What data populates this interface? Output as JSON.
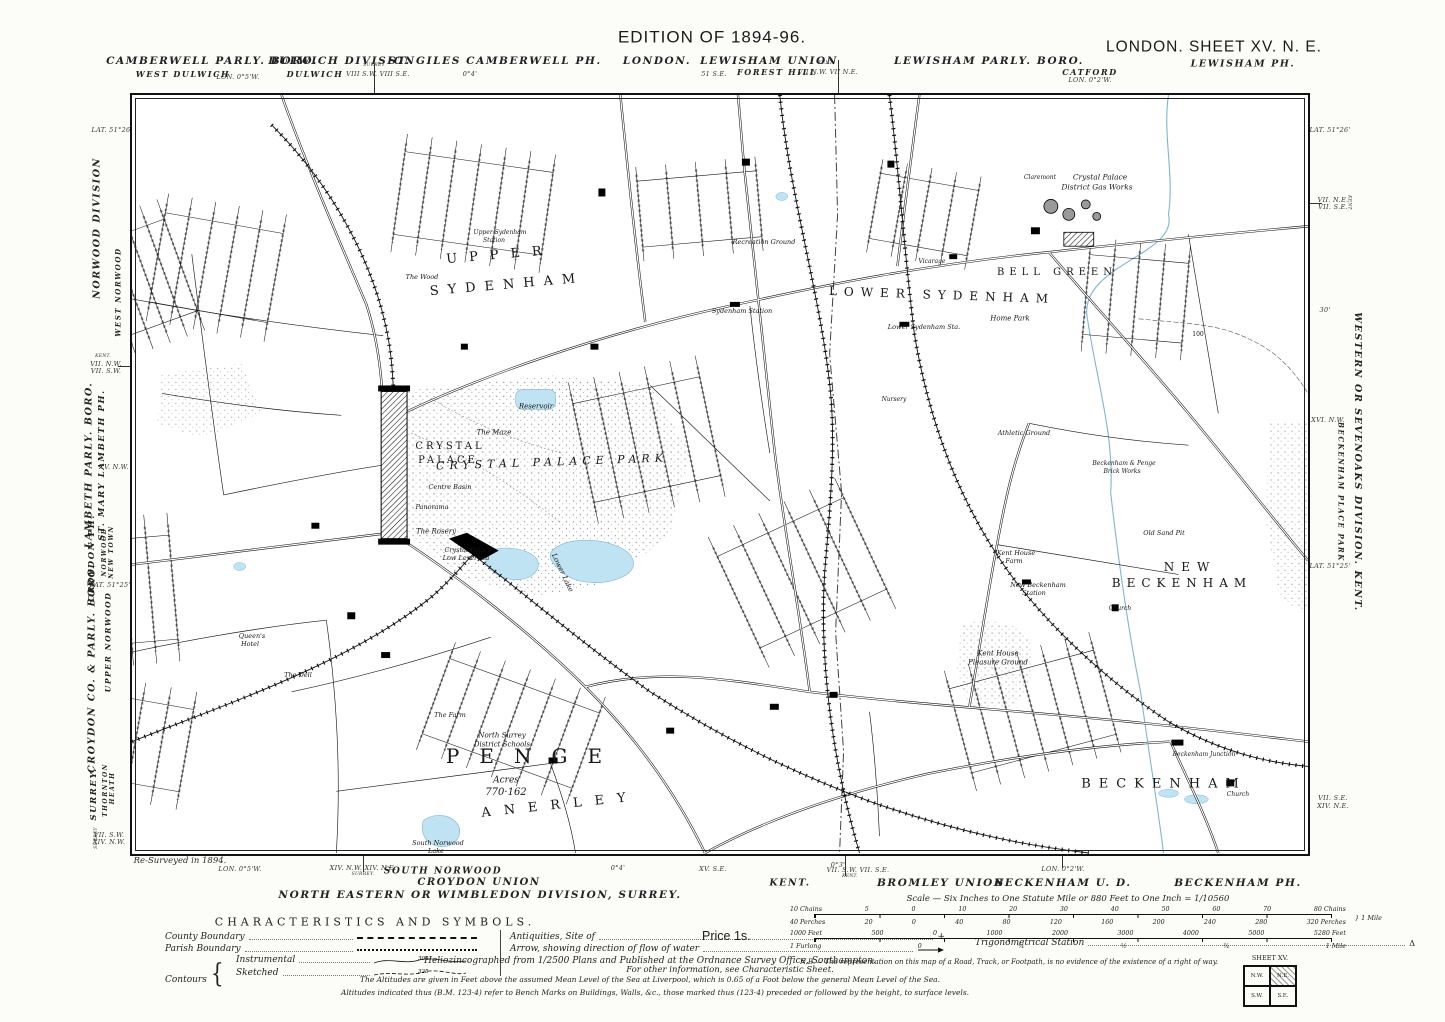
{
  "title": "Ordnance Survey six-inch map, London Sheet XV N.E., Edition of 1894-96",
  "margins": {
    "labels": [
      {
        "t": "EDITION OF 1894-96.",
        "x": 712,
        "y": 37,
        "s": 17,
        "c": "h1"
      },
      {
        "t": "LONDON.  SHEET  XV.  N. E.",
        "x": 1214,
        "y": 47,
        "s": 15.5,
        "c": "h1"
      },
      {
        "t": "LEWISHAM PH.",
        "x": 1243,
        "y": 64,
        "s": 9.5,
        "c": "sbi"
      },
      {
        "t": "CAMBERWELL PARLY. BORO.",
        "x": 212,
        "y": 61,
        "s": 10.5,
        "c": "sbi"
      },
      {
        "t": "WEST DULWICH",
        "x": 183,
        "y": 74,
        "s": 8,
        "c": "sbi"
      },
      {
        "t": "LON. 0°5'W.",
        "x": 238,
        "y": 77,
        "c": "ty"
      },
      {
        "t": "DULWICH DIVISION",
        "x": 342,
        "y": 61,
        "s": 10.5,
        "c": "sbi"
      },
      {
        "t": "DULWICH",
        "x": 315,
        "y": 74,
        "s": 8,
        "c": "sbi"
      },
      {
        "t": "SURREY",
        "x": 374,
        "y": 66,
        "s": 4.5,
        "c": "ty"
      },
      {
        "t": "VIII S.W.   VIII S.E.",
        "x": 378,
        "y": 74,
        "c": "ty"
      },
      {
        "t": "ST. GILES CAMBERWELL PH.",
        "x": 495,
        "y": 61,
        "s": 10.5,
        "c": "sbi"
      },
      {
        "t": "0°4'",
        "x": 470,
        "y": 74,
        "c": "ty"
      },
      {
        "t": "LONDON.",
        "x": 657,
        "y": 61,
        "s": 10.5,
        "c": "sbi"
      },
      {
        "t": "LEWISHAM UNION",
        "x": 769,
        "y": 61,
        "s": 10.5,
        "c": "sbi"
      },
      {
        "t": "FOREST HILL",
        "x": 777,
        "y": 72,
        "s": 8,
        "c": "sbi"
      },
      {
        "t": "51 S.E.",
        "x": 714,
        "y": 74,
        "c": "ty"
      },
      {
        "t": "KENT.",
        "x": 826,
        "y": 64,
        "s": 4.5,
        "c": "ty"
      },
      {
        "t": "VII N.W.   VII N.E.",
        "x": 828,
        "y": 72,
        "c": "ty"
      },
      {
        "t": "LEWISHAM PARLY. BORO.",
        "x": 989,
        "y": 61,
        "s": 10.5,
        "c": "sbi"
      },
      {
        "t": "CATFORD",
        "x": 1090,
        "y": 72,
        "s": 8,
        "c": "sbi"
      },
      {
        "t": "LON. 0°2'W.",
        "x": 1090,
        "y": 80,
        "c": "ty"
      },
      {
        "t": "LAT. 51°26'",
        "x": 112,
        "y": 130,
        "c": "ty"
      },
      {
        "t": "NORWOOD DIVISION",
        "x": 97,
        "y": 228,
        "s": 9.5,
        "c": "sbi",
        "r": -90
      },
      {
        "t": "KENT.",
        "x": 103,
        "y": 357,
        "s": 4.5,
        "c": "ty"
      },
      {
        "t": "VII. N.W.",
        "x": 106,
        "y": 364,
        "c": "ty"
      },
      {
        "t": "VII. S.W.",
        "x": 106,
        "y": 371,
        "c": "ty"
      },
      {
        "t": "WEST NORWOOD",
        "x": 118,
        "y": 292,
        "s": 7,
        "c": "sbi",
        "r": -90
      },
      {
        "t": "LAMBETH PARLY. BORO.",
        "x": 89,
        "y": 465,
        "s": 9.5,
        "c": "sbi",
        "r": -90
      },
      {
        "t": "ST. MARY LAMBETH PH.",
        "x": 102,
        "y": 465,
        "s": 8.5,
        "c": "sbi",
        "r": -90
      },
      {
        "t": "XV. N.W.",
        "x": 114,
        "y": 467,
        "c": "ty"
      },
      {
        "t": "CROYDON PH.",
        "x": 92,
        "y": 558,
        "s": 8.5,
        "c": "sbi",
        "r": -90
      },
      {
        "t": "NORWOOD",
        "x": 105,
        "y": 552,
        "s": 6,
        "c": "sbi",
        "r": -90
      },
      {
        "t": "NEW TOWN",
        "x": 112,
        "y": 552,
        "s": 6,
        "c": "sbi",
        "r": -90
      },
      {
        "t": "LAT. 51°25'",
        "x": 110,
        "y": 585,
        "c": "ty"
      },
      {
        "t": "CROYDON CO. & PARLY. BORO.",
        "x": 92,
        "y": 668,
        "s": 9.5,
        "c": "sbi",
        "r": -90
      },
      {
        "t": "UPPER NORWOOD",
        "x": 108,
        "y": 642,
        "s": 7.5,
        "c": "sbi",
        "r": -90
      },
      {
        "t": "SURREY.",
        "x": 94,
        "y": 794,
        "s": 8.5,
        "c": "sbi",
        "r": -90
      },
      {
        "t": "THORNTON",
        "x": 106,
        "y": 790,
        "s": 6,
        "c": "sbi",
        "r": -90
      },
      {
        "t": "HEATH",
        "x": 113,
        "y": 788,
        "s": 6,
        "c": "sbi",
        "r": -90
      },
      {
        "t": "SURREY",
        "x": 97,
        "y": 838,
        "s": 4.5,
        "c": "ty",
        "r": -90
      },
      {
        "t": "VII. S.W.",
        "x": 109,
        "y": 835,
        "c": "ty"
      },
      {
        "t": "XIV. N.W.",
        "x": 109,
        "y": 842,
        "c": "ty"
      },
      {
        "t": "LAT. 51°26'",
        "x": 1330,
        "y": 130,
        "c": "ty"
      },
      {
        "t": "VII. N.E.",
        "x": 1333,
        "y": 200,
        "c": "ty"
      },
      {
        "t": "VII. S.E.",
        "x": 1333,
        "y": 207,
        "c": "ty"
      },
      {
        "t": "KENT.",
        "x": 1348,
        "y": 203,
        "s": 4.5,
        "c": "ty",
        "r": 90
      },
      {
        "t": "30'",
        "x": 1325,
        "y": 310,
        "c": "ty"
      },
      {
        "t": "WESTERN OR SEVENOAKS DIVISION.  KENT.",
        "x": 1357,
        "y": 462,
        "s": 9.5,
        "c": "sbi",
        "r": 90
      },
      {
        "t": "XVI. N.W.",
        "x": 1328,
        "y": 420,
        "c": "ty"
      },
      {
        "t": "BECKENHAM PLACE PARK",
        "x": 1341,
        "y": 492,
        "s": 7,
        "c": "sbi",
        "r": 90
      },
      {
        "t": "LAT. 51°25'",
        "x": 1330,
        "y": 566,
        "c": "ty"
      },
      {
        "t": "VII. S.E.",
        "x": 1333,
        "y": 798,
        "c": "ty"
      },
      {
        "t": "XIV. N.E.",
        "x": 1333,
        "y": 806,
        "c": "ty"
      },
      {
        "t": "Re-Surveyed in 1894.",
        "x": 180,
        "y": 861,
        "s": 8.5,
        "c": "scr"
      },
      {
        "t": "LON. 0°5'W.",
        "x": 240,
        "y": 869,
        "c": "ty"
      },
      {
        "t": "XIV. N.W.   XIV. N.E.",
        "x": 363,
        "y": 868,
        "c": "ty"
      },
      {
        "t": "SURREY.",
        "x": 363,
        "y": 875,
        "s": 4.5,
        "c": "ty"
      },
      {
        "t": "SOUTH NORWOOD",
        "x": 443,
        "y": 872,
        "s": 9,
        "c": "sbi"
      },
      {
        "t": "CROYDON UNION",
        "x": 479,
        "y": 883,
        "s": 10,
        "c": "sbi"
      },
      {
        "t": "NORTH EASTERN OR WIMBLEDON DIVISION,  SURREY.",
        "x": 480,
        "y": 895,
        "s": 10.5,
        "c": "sbi"
      },
      {
        "t": "0°4'",
        "x": 618,
        "y": 868,
        "c": "ty"
      },
      {
        "t": "XV. S.E.",
        "x": 713,
        "y": 869,
        "c": "ty"
      },
      {
        "t": "KENT.",
        "x": 790,
        "y": 883,
        "s": 9.5,
        "c": "sbi"
      },
      {
        "t": "0°3'",
        "x": 838,
        "y": 865,
        "c": "ty"
      },
      {
        "t": "VII. S.W.   VII. S.E.",
        "x": 858,
        "y": 870,
        "c": "ty"
      },
      {
        "t": "KENT.",
        "x": 850,
        "y": 877,
        "s": 4.5,
        "c": "ty"
      },
      {
        "t": "BROMLEY UNION",
        "x": 941,
        "y": 883,
        "s": 10.5,
        "c": "sbi"
      },
      {
        "t": "LON. 0°2'W.",
        "x": 1063,
        "y": 869,
        "c": "ty"
      },
      {
        "t": "BECKENHAM U. D.",
        "x": 1063,
        "y": 883,
        "s": 10.5,
        "c": "sbi"
      },
      {
        "t": "BECKENHAM PH.",
        "x": 1238,
        "y": 883,
        "s": 10.5,
        "c": "sbi"
      }
    ]
  },
  "map": {
    "labels": [
      {
        "t": "Upper Sydenham",
        "x": 368,
        "y": 138,
        "s": 6,
        "i": 1
      },
      {
        "t": "Station",
        "x": 362,
        "y": 146,
        "s": 6,
        "i": 1
      },
      {
        "t": "The Wood",
        "x": 290,
        "y": 182,
        "s": 6.5,
        "i": 1
      },
      {
        "t": "UPPER",
        "x": 368,
        "y": 160,
        "s": 13,
        "ls": 12,
        "r": -5
      },
      {
        "t": "SYDENHAM",
        "x": 375,
        "y": 190,
        "s": 13,
        "ls": 9,
        "r": -5
      },
      {
        "t": "LOWER SYDENHAM",
        "x": 810,
        "y": 200,
        "s": 12,
        "ls": 7,
        "r": 2
      },
      {
        "t": "BELL GREEN",
        "x": 925,
        "y": 178,
        "s": 10,
        "ls": 5
      },
      {
        "t": "Sydenham Station",
        "x": 610,
        "y": 216,
        "s": 6.5,
        "i": 1
      },
      {
        "t": "Lower Sydenham Sta.",
        "x": 792,
        "y": 232,
        "s": 6.5,
        "i": 1
      },
      {
        "t": "Recreation Ground",
        "x": 632,
        "y": 147,
        "s": 6.5,
        "i": 1
      },
      {
        "t": "Vicarage",
        "x": 800,
        "y": 167,
        "s": 6,
        "i": 1
      },
      {
        "t": "Home Park",
        "x": 878,
        "y": 224,
        "s": 7,
        "i": 1
      },
      {
        "t": "Nursery",
        "x": 762,
        "y": 305,
        "s": 6,
        "i": 1
      },
      {
        "t": "Claremont",
        "x": 908,
        "y": 83,
        "s": 6,
        "i": 1
      },
      {
        "t": "Crystal Palace",
        "x": 968,
        "y": 82,
        "s": 7.5,
        "i": 1
      },
      {
        "t": "District Gas Works",
        "x": 965,
        "y": 92,
        "s": 7.5,
        "i": 1
      },
      {
        "t": "CRYSTAL",
        "x": 318,
        "y": 352,
        "s": 10,
        "ls": 3
      },
      {
        "t": "PALACE",
        "x": 316,
        "y": 366,
        "s": 10,
        "ls": 3
      },
      {
        "t": "CRYSTAL   PALACE   PARK",
        "x": 420,
        "y": 367,
        "s": 11,
        "ls": 5,
        "i": 1,
        "r": -2
      },
      {
        "t": "Reservoir",
        "x": 404,
        "y": 312,
        "s": 7,
        "i": 1
      },
      {
        "t": "The Maze",
        "x": 362,
        "y": 338,
        "s": 7,
        "i": 1
      },
      {
        "t": "Centre Basin",
        "x": 318,
        "y": 392,
        "s": 6.5,
        "i": 1
      },
      {
        "t": "Panorama",
        "x": 300,
        "y": 412,
        "s": 6.5,
        "i": 1
      },
      {
        "t": "The Rosery",
        "x": 304,
        "y": 437,
        "s": 7,
        "i": 1
      },
      {
        "t": "Crystal Palace",
        "x": 336,
        "y": 455,
        "s": 6.5,
        "i": 1
      },
      {
        "t": "Low Level Sta",
        "x": 334,
        "y": 463,
        "s": 6.5,
        "i": 1
      },
      {
        "t": "Lower Lake",
        "x": 430,
        "y": 478,
        "s": 7,
        "i": 1,
        "r": 65
      },
      {
        "t": "Queen's",
        "x": 120,
        "y": 541,
        "s": 6.5,
        "i": 1
      },
      {
        "t": "Hotel",
        "x": 118,
        "y": 549,
        "s": 6.5,
        "i": 1
      },
      {
        "t": "The Dell",
        "x": 166,
        "y": 580,
        "s": 6.5,
        "i": 1
      },
      {
        "t": "The Farm",
        "x": 318,
        "y": 620,
        "s": 6.5,
        "i": 1
      },
      {
        "t": "North Surrey",
        "x": 370,
        "y": 641,
        "s": 7,
        "i": 1
      },
      {
        "t": "District Schools",
        "x": 370,
        "y": 650,
        "s": 7,
        "i": 1
      },
      {
        "t": "PENGE",
        "x": 402,
        "y": 661,
        "s": 20,
        "ls": 20
      },
      {
        "t": "Acres",
        "x": 374,
        "y": 686,
        "s": 9,
        "i": 1
      },
      {
        "t": "770·162",
        "x": 374,
        "y": 698,
        "s": 10,
        "i": 1
      },
      {
        "t": "ANERLEY",
        "x": 428,
        "y": 710,
        "s": 13,
        "ls": 13,
        "r": -6
      },
      {
        "t": "South Norwood",
        "x": 306,
        "y": 748,
        "s": 6.5,
        "i": 1
      },
      {
        "t": "Lake",
        "x": 304,
        "y": 756,
        "s": 6.5,
        "i": 1
      },
      {
        "t": "Athletic Ground",
        "x": 892,
        "y": 338,
        "s": 6.5,
        "i": 1
      },
      {
        "t": "Beckenham & Penge",
        "x": 992,
        "y": 369,
        "s": 6,
        "i": 1
      },
      {
        "t": "Brick Works",
        "x": 990,
        "y": 377,
        "s": 6,
        "i": 1
      },
      {
        "t": "Old Sand Pit",
        "x": 1032,
        "y": 438,
        "s": 6.5,
        "i": 1
      },
      {
        "t": "100",
        "x": 1066,
        "y": 240,
        "s": 6
      },
      {
        "t": "Kent House",
        "x": 884,
        "y": 458,
        "s": 6.5,
        "i": 1
      },
      {
        "t": "Farm",
        "x": 882,
        "y": 466,
        "s": 6.5,
        "i": 1
      },
      {
        "t": "New Beckenham",
        "x": 906,
        "y": 490,
        "s": 6.5,
        "i": 1
      },
      {
        "t": "Station",
        "x": 902,
        "y": 498,
        "s": 6.5,
        "i": 1
      },
      {
        "t": "NEW",
        "x": 1058,
        "y": 472,
        "s": 12,
        "ls": 7
      },
      {
        "t": "BECKENHAM",
        "x": 1050,
        "y": 488,
        "s": 12,
        "ls": 6
      },
      {
        "t": "Church",
        "x": 988,
        "y": 514,
        "s": 6,
        "i": 1
      },
      {
        "t": "Kent House",
        "x": 866,
        "y": 559,
        "s": 7,
        "i": 1
      },
      {
        "t": "Pleasure Ground",
        "x": 866,
        "y": 568,
        "s": 7,
        "i": 1
      },
      {
        "t": "BECKENHAM",
        "x": 1032,
        "y": 689,
        "s": 13,
        "ls": 8
      },
      {
        "t": "Beckenham Junction",
        "x": 1072,
        "y": 660,
        "s": 6,
        "i": 1
      },
      {
        "t": "Church",
        "x": 1106,
        "y": 700,
        "s": 6,
        "i": 1
      }
    ]
  },
  "legend": {
    "title": "CHARACTERISTICS AND SYMBOLS.",
    "county": "County Boundary",
    "parish": "Parish Boundary",
    "contours": "Contours",
    "instrumental": "Instrumental",
    "sketched": "Sketched",
    "contour_value_instr": "300",
    "contour_value_sketch": "325",
    "antiquities": "Antiquities, Site of",
    "antiquities_symbol": "+",
    "arrow": "Arrow, showing direction of flow of water",
    "info": "For other information, see Characteristic Sheet.",
    "trig": "Trigonometrical Station",
    "trig_symbol": "Δ",
    "price": "Price 1s."
  },
  "scale": {
    "title": "Scale — Six Inches to One Statute Mile or 880 Feet to One Inch = 1/10560",
    "ruler1_top": [
      "10 Chains",
      "5",
      "0",
      "10",
      "20",
      "30",
      "40",
      "50",
      "60",
      "70",
      "80 Chains"
    ],
    "ruler1_bottom": [
      "40 Perches",
      "20",
      "0",
      "40",
      "80",
      "120",
      "160",
      "200",
      "240",
      "280",
      "320 Perches"
    ],
    "ruler1_right": "1 Mile",
    "ruler2_top": [
      "1000 Feet",
      "500",
      "0",
      "1000",
      "2000",
      "3000",
      "4000",
      "5000",
      "5280 Feet"
    ],
    "ruler2_bottom": [
      "1 Furlong",
      "0",
      "¼",
      "½",
      "¾",
      "1 Mile"
    ]
  },
  "notes": {
    "helio": "Heliozincographed from 1/2500 Plans and Published at the Ordnance Survey Office, Southampton.",
    "nb": "N.B.— The representation on this map of a Road, Track, or Footpath, is no evidence of the existence of a right of way.",
    "alt1": "The Altitudes are given in Feet above the assumed Mean Level of the Sea at Liverpool, which is 0.65 of a Foot below the general Mean Level of the Sea.",
    "alt2": "Altitudes indicated thus (B.M. 123·4) refer to Bench Marks on Buildings, Walls, &c., those marked thus (123·4) preceded or followed by the height, to surface levels."
  },
  "sheet_diagram": {
    "title": "SHEET  XV.",
    "cells": [
      "N.W.",
      "N.E.",
      "S.W.",
      "S.E."
    ]
  },
  "colors": {
    "water": "#bfe3f2",
    "water_line": "#7fb5cf",
    "ink": "#161616",
    "paper": "#ffffff"
  }
}
